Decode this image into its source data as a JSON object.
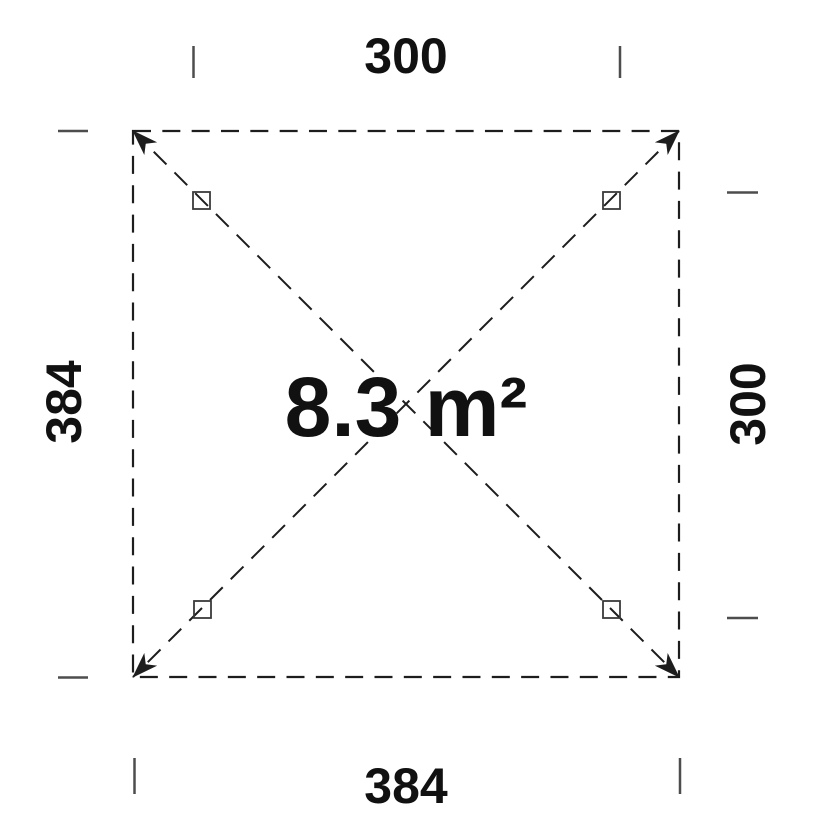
{
  "drawing": {
    "title": "gazebo floor plan",
    "area": {
      "label": "8.3 m²"
    },
    "dimensions": {
      "top": {
        "label": "300"
      },
      "bottom": {
        "label": "384"
      },
      "left": {
        "label": "384"
      },
      "right": {
        "label": "300"
      }
    },
    "posts_count": 4
  },
  "colors": {
    "background": "#ffffff",
    "outline": "#1d1d1d",
    "tick": "#4d4d4d",
    "post": "#3a3a3a",
    "text": "#111111"
  }
}
